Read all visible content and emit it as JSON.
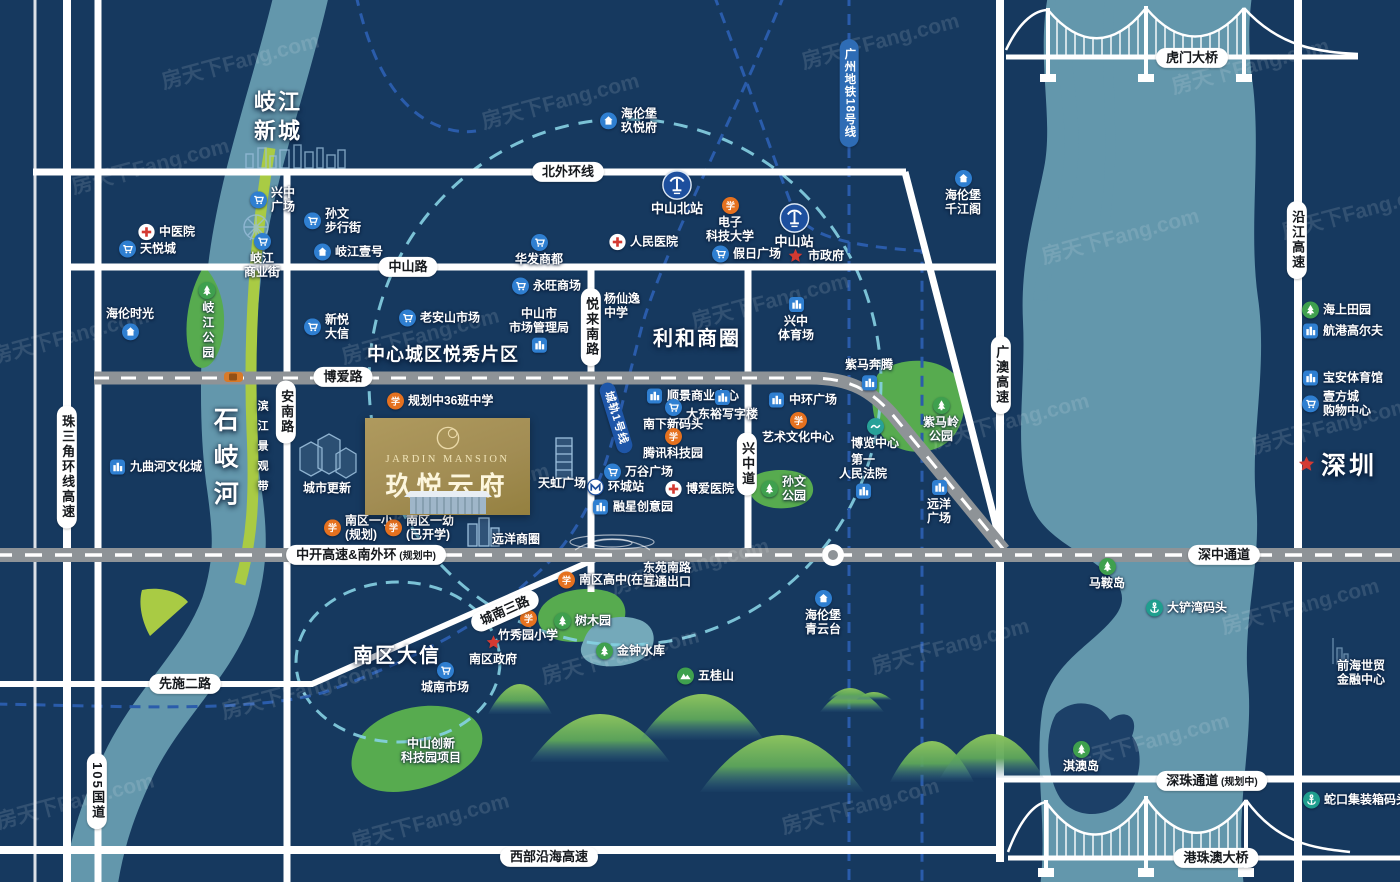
{
  "project": {
    "name_en": "JARDIN MANSION",
    "name_cn": "玖悦云府"
  },
  "map": {
    "colors": {
      "background": "#16395f",
      "water": "#6397ac",
      "park_green": "#57ab4f",
      "belt_green": "#a9cb44",
      "road_gray": "#8e9397",
      "rail_blue": "#2a5cab",
      "circle_teal": "#86d2e3",
      "project_gold": "#a28d54",
      "accent_red": "#d43a32"
    },
    "watermark": {
      "text": "房天下Fang.com",
      "positions": [
        [
          150,
          165
        ],
        [
          70,
          335
        ],
        [
          300,
          690
        ],
        [
          75,
          800
        ],
        [
          420,
          335
        ],
        [
          560,
          100
        ],
        [
          470,
          490
        ],
        [
          620,
          655
        ],
        [
          770,
          300
        ],
        [
          880,
          40
        ],
        [
          950,
          645
        ],
        [
          1010,
          420
        ],
        [
          1120,
          235
        ],
        [
          1150,
          740
        ],
        [
          1250,
          65
        ],
        [
          1330,
          425
        ],
        [
          1300,
          605
        ],
        [
          860,
          805
        ],
        [
          430,
          820
        ],
        [
          690,
          565
        ],
        [
          240,
          60
        ],
        [
          1360,
          210
        ]
      ]
    },
    "area_labels": [
      {
        "text": "岐江\n新城",
        "x": 278,
        "y": 117,
        "size": 22,
        "ls": 2
      },
      {
        "text": "中心城区悦秀片区",
        "x": 443,
        "y": 355,
        "size": 18,
        "ls": 1
      },
      {
        "text": "利和商圈",
        "x": 697,
        "y": 339,
        "size": 20,
        "ls": 2
      },
      {
        "text": "南区大信",
        "x": 397,
        "y": 656,
        "size": 20,
        "ls": 2
      },
      {
        "text": "石岐河",
        "x": 224,
        "y": 462,
        "size": 25,
        "ls": 12,
        "vertical": true
      },
      {
        "text": "滨江景观带",
        "x": 262,
        "y": 450,
        "size": 11,
        "ls": 9,
        "vertical": true
      },
      {
        "text": "深圳",
        "x": 1337,
        "y": 466,
        "size": 25,
        "ls": 3,
        "star": true
      }
    ],
    "road_labels": [
      {
        "text": "北外环线",
        "x": 568,
        "y": 172
      },
      {
        "text": "中山路",
        "x": 408,
        "y": 267
      },
      {
        "text": "博爱路",
        "x": 343,
        "y": 377
      },
      {
        "text": "悦来南路",
        "x": 591,
        "y": 327,
        "v": true
      },
      {
        "text": "安南路",
        "x": 286,
        "y": 412,
        "v": true
      },
      {
        "text": "兴中道",
        "x": 747,
        "y": 464,
        "v": true
      },
      {
        "text": "珠三角环线高速",
        "x": 67,
        "y": 467,
        "v": true
      },
      {
        "text": "105国道",
        "x": 97,
        "y": 791,
        "v": true
      },
      {
        "text": "广澳高速",
        "x": 1001,
        "y": 375,
        "v": true
      },
      {
        "text": "沿江高速",
        "x": 1297,
        "y": 240,
        "v": true
      },
      {
        "text": "中开高速&南外环",
        "sub": "(规划中)",
        "x": 366,
        "y": 555
      },
      {
        "text": "深中通道",
        "x": 1224,
        "y": 555
      },
      {
        "text": "深珠通道",
        "sub": "(规划中)",
        "x": 1212,
        "y": 781
      },
      {
        "text": "先施二路",
        "x": 185,
        "y": 684
      },
      {
        "text": "西部沿海高速",
        "x": 549,
        "y": 857
      },
      {
        "text": "城南三路",
        "x": 505,
        "y": 611,
        "rot": -24
      },
      {
        "text": "虎门大桥",
        "x": 1192,
        "y": 58
      },
      {
        "text": "港珠澳大桥",
        "x": 1216,
        "y": 858
      },
      {
        "text": "广州地铁18号线",
        "x": 849,
        "y": 93,
        "v": true,
        "style": "blue"
      },
      {
        "text": "城轨1号线",
        "x": 616,
        "y": 418,
        "rot": 73,
        "style": "navy"
      }
    ],
    "pois": [
      {
        "t": "hospital",
        "x": 147,
        "y": 232,
        "lines": [
          "中医院"
        ],
        "lay": "right"
      },
      {
        "t": "cart",
        "x": 128,
        "y": 249,
        "lines": [
          "天悦城"
        ],
        "lay": "right"
      },
      {
        "t": "cart",
        "x": 259,
        "y": 200,
        "lines": [
          "兴中",
          "广场"
        ],
        "lay": "right"
      },
      {
        "t": "cart",
        "x": 262,
        "y": 243,
        "lines": [
          "岐江",
          "商业街"
        ],
        "lay": "below"
      },
      {
        "t": "cart",
        "x": 313,
        "y": 221,
        "lines": [
          "孙文",
          "步行街"
        ],
        "lay": "right"
      },
      {
        "t": "home",
        "x": 323,
        "y": 252,
        "lines": [
          "岐江壹号"
        ],
        "lay": "right"
      },
      {
        "t": "home",
        "x": 130,
        "y": 322,
        "lines": [
          "海伦时光"
        ],
        "lay": "above"
      },
      {
        "t": "park",
        "x": 207,
        "y": 292,
        "lines": [
          "岐江公园"
        ],
        "lay": "bv"
      },
      {
        "t": "landmark",
        "x": 118,
        "y": 467,
        "lines": [
          "九曲河文化城"
        ],
        "lay": "right"
      },
      {
        "t": "cart",
        "x": 313,
        "y": 327,
        "lines": [
          "新悦",
          "大信"
        ],
        "lay": "right"
      },
      {
        "t": "cart",
        "x": 408,
        "y": 318,
        "lines": [
          "老安山市场"
        ],
        "lay": "right"
      },
      {
        "t": "home",
        "x": 609,
        "y": 121,
        "lines": [
          "海伦堡",
          "玖悦府"
        ],
        "lay": "right"
      },
      {
        "t": "station",
        "x": 677,
        "y": 180,
        "lines": [
          "中山北站"
        ],
        "lay": "below"
      },
      {
        "t": "station",
        "x": 794,
        "y": 213,
        "lines": [
          "中山站"
        ],
        "lay": "below"
      },
      {
        "t": "school",
        "x": 730,
        "y": 207,
        "lines": [
          "电子",
          "科技大学"
        ],
        "lay": "below"
      },
      {
        "t": "hospital",
        "x": 618,
        "y": 242,
        "lines": [
          "人民医院"
        ],
        "lay": "right"
      },
      {
        "t": "cart",
        "x": 539,
        "y": 244,
        "lines": [
          "华发商都"
        ],
        "lay": "below"
      },
      {
        "t": "cart",
        "x": 721,
        "y": 254,
        "lines": [
          "假日广场"
        ],
        "lay": "right"
      },
      {
        "t": "star",
        "x": 796,
        "y": 256,
        "lines": [
          "市政府"
        ],
        "lay": "right"
      },
      {
        "t": "cart",
        "x": 521,
        "y": 286,
        "lines": [
          "永旺商场"
        ],
        "lay": "right"
      },
      {
        "t": "school",
        "x": 592,
        "y": 306,
        "lines": [
          "杨仙逸",
          "中学"
        ],
        "lay": "right"
      },
      {
        "t": "landmark",
        "x": 539,
        "y": 336,
        "lines": [
          "中山市",
          "市场管理局"
        ],
        "lay": "above"
      },
      {
        "t": "landmark",
        "x": 796,
        "y": 306,
        "lines": [
          "兴中",
          "体育场"
        ],
        "lay": "below"
      },
      {
        "t": "landmark",
        "x": 869,
        "y": 373,
        "lines": [
          "紫马奔腾"
        ],
        "lay": "above"
      },
      {
        "t": "park",
        "x": 941,
        "y": 407,
        "lines": [
          "紫马岭",
          "公园"
        ],
        "lay": "below"
      },
      {
        "t": "home",
        "x": 963,
        "y": 180,
        "lines": [
          "海伦堡",
          "千江阁"
        ],
        "lay": "below"
      },
      {
        "t": "school",
        "x": 396,
        "y": 401,
        "lines": [
          "规划中36班中学"
        ],
        "lay": "right"
      },
      {
        "t": "landmark",
        "x": 655,
        "y": 396,
        "lines": [
          "顺景商业中心"
        ],
        "lay": "right"
      },
      {
        "t": "landmark",
        "x": 722,
        "y": 399,
        "lines": [
          "大东裕写字楼"
        ],
        "lay": "below"
      },
      {
        "t": "cart",
        "x": 673,
        "y": 409,
        "lines": [
          "南下新码头"
        ],
        "lay": "below"
      },
      {
        "t": "school",
        "x": 673,
        "y": 438,
        "lines": [
          "腾讯科技园"
        ],
        "lay": "below"
      },
      {
        "t": "cart",
        "x": 613,
        "y": 472,
        "lines": [
          "万谷广场"
        ],
        "lay": "right"
      },
      {
        "t": "metro",
        "x": 596,
        "y": 487,
        "lines": [
          "环城站"
        ],
        "lay": "right"
      },
      {
        "t": "hospital",
        "x": 674,
        "y": 489,
        "lines": [
          "博爱医院"
        ],
        "lay": "right"
      },
      {
        "t": "landmark",
        "x": 601,
        "y": 507,
        "lines": [
          "融星创意园"
        ],
        "lay": "right"
      },
      {
        "t": "landmark",
        "x": 777,
        "y": 400,
        "lines": [
          "中环广场"
        ],
        "lay": "right"
      },
      {
        "t": "school",
        "x": 798,
        "y": 422,
        "lines": [
          "艺术文化中心"
        ],
        "lay": "below"
      },
      {
        "t": "teal",
        "x": 875,
        "y": 428,
        "lines": [
          "博览中心"
        ],
        "lay": "below"
      },
      {
        "t": "landmark",
        "x": 863,
        "y": 482,
        "lines": [
          "第一",
          "人民法院"
        ],
        "lay": "above"
      },
      {
        "t": "park",
        "x": 770,
        "y": 489,
        "lines": [
          "孙文",
          "公园"
        ],
        "lay": "right"
      },
      {
        "t": "landmark",
        "x": 939,
        "y": 489,
        "lines": [
          "远洋",
          "广场"
        ],
        "lay": "below"
      },
      {
        "t": "school",
        "x": 333,
        "y": 528,
        "lines": [
          "南区一小",
          "(规划)"
        ],
        "lay": "right"
      },
      {
        "t": "school",
        "x": 394,
        "y": 528,
        "lines": [
          "南区一幼",
          "(已开学)"
        ],
        "lay": "right"
      },
      {
        "t": "school",
        "x": 567,
        "y": 580,
        "lines": [
          "南区高中(在建)"
        ],
        "lay": "right"
      },
      {
        "t": "text",
        "x": 667,
        "y": 575,
        "lines": [
          "东苑南路",
          "互通出口"
        ],
        "lay": "text"
      },
      {
        "t": "home",
        "x": 823,
        "y": 600,
        "lines": [
          "海伦堡",
          "青云台"
        ],
        "lay": "below"
      },
      {
        "t": "text",
        "x": 327,
        "y": 489,
        "lines": [
          "城市更新"
        ],
        "lay": "text"
      },
      {
        "t": "text",
        "x": 562,
        "y": 484,
        "lines": [
          "天虹广场"
        ],
        "lay": "text"
      },
      {
        "t": "text",
        "x": 516,
        "y": 540,
        "lines": [
          "远洋商圈"
        ],
        "lay": "text"
      },
      {
        "t": "park",
        "x": 563,
        "y": 621,
        "lines": [
          "树木园"
        ],
        "lay": "right"
      },
      {
        "t": "park",
        "x": 605,
        "y": 651,
        "lines": [
          "金钟水库"
        ],
        "lay": "right"
      },
      {
        "t": "mountain",
        "x": 686,
        "y": 676,
        "lines": [
          "五桂山"
        ],
        "lay": "right"
      },
      {
        "t": "school",
        "x": 528,
        "y": 620,
        "lines": [
          "竹秀园小学"
        ],
        "lay": "below"
      },
      {
        "t": "star",
        "x": 493,
        "y": 644,
        "lines": [
          "南区政府"
        ],
        "lay": "below"
      },
      {
        "t": "cart",
        "x": 445,
        "y": 672,
        "lines": [
          "城南市场"
        ],
        "lay": "below"
      },
      {
        "t": "text",
        "x": 431,
        "y": 751,
        "lines": [
          "中山创新",
          "科技园项目"
        ],
        "lay": "text"
      },
      {
        "t": "park",
        "x": 1107,
        "y": 568,
        "lines": [
          "马鞍岛"
        ],
        "lay": "below"
      },
      {
        "t": "anchor",
        "x": 1155,
        "y": 608,
        "lines": [
          "大铲湾码头"
        ],
        "lay": "right"
      },
      {
        "t": "park",
        "x": 1081,
        "y": 751,
        "lines": [
          "淇澳岛"
        ],
        "lay": "below"
      },
      {
        "t": "text",
        "x": 1361,
        "y": 673,
        "lines": [
          "前海世贸",
          "金融中心"
        ],
        "lay": "text"
      },
      {
        "t": "anchor",
        "x": 1312,
        "y": 800,
        "lines": [
          "蛇口集装箱码头"
        ],
        "lay": "right"
      },
      {
        "t": "park",
        "x": 1311,
        "y": 310,
        "lines": [
          "海上田园"
        ],
        "lay": "right"
      },
      {
        "t": "landmark",
        "x": 1311,
        "y": 331,
        "lines": [
          "航港高尔夫"
        ],
        "lay": "right"
      },
      {
        "t": "landmark",
        "x": 1311,
        "y": 378,
        "lines": [
          "宝安体育馆"
        ],
        "lay": "right"
      },
      {
        "t": "cart",
        "x": 1311,
        "y": 404,
        "lines": [
          "壹方城",
          "购物中心"
        ],
        "lay": "right"
      }
    ]
  }
}
